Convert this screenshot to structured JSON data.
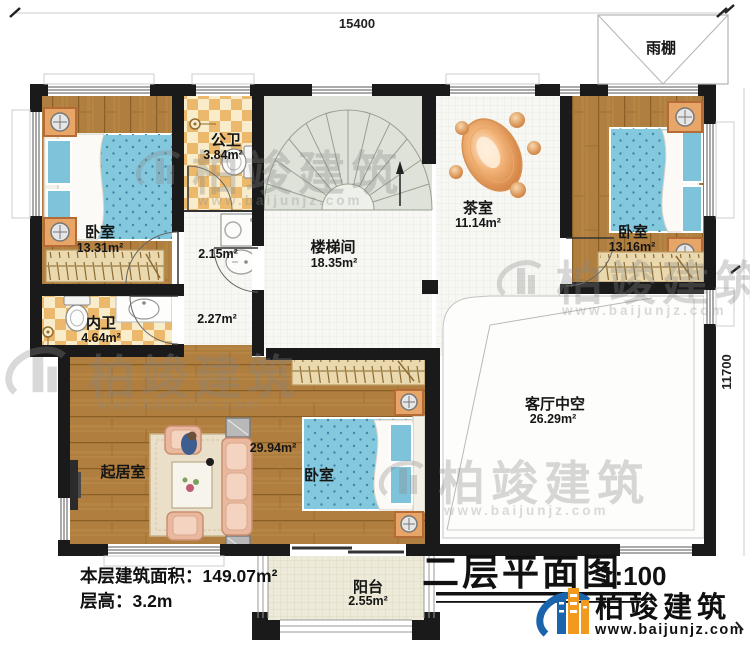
{
  "dimensions": {
    "width": "15400",
    "height": "11700"
  },
  "rooms": [
    {
      "name": "卧室",
      "area": "13.31m²"
    },
    {
      "name": "公卫",
      "area": "3.84m²"
    },
    {
      "name": "楼梯间",
      "area": "18.35m²"
    },
    {
      "name": "茶室",
      "area": "11.14m²"
    },
    {
      "name": "卧室",
      "area": "13.16m²"
    },
    {
      "name": "内卫",
      "area": "4.64m²"
    },
    {
      "name": "起居室"
    },
    {
      "name": "卧室",
      "area": "29.94m²"
    },
    {
      "name": "客厅中空",
      "area": "26.29m²"
    },
    {
      "name": "阳台",
      "area": "2.55m²"
    },
    {
      "name": "雨棚"
    }
  ],
  "small_areas": {
    "laundry": "2.15m²",
    "hall": "2.27m²"
  },
  "info": {
    "area": "本层建筑面积：149.07m²",
    "floor_height": "层高：3.2m"
  },
  "title": {
    "text": "二层平面图",
    "scale": "1:100"
  },
  "brand": {
    "name": "柏竣建筑",
    "url": "www.baijunjz.com"
  },
  "watermark": {
    "name": "柏竣建筑",
    "url": "www.baijunjz.com"
  },
  "colors": {
    "wall": "#1a1a1a",
    "wood": "#b07e3e",
    "checker": "#ecb96c",
    "bed_blue": "#84c8de",
    "brand_blue": "#1a63ad",
    "brand_orange": "#f29a1d"
  }
}
